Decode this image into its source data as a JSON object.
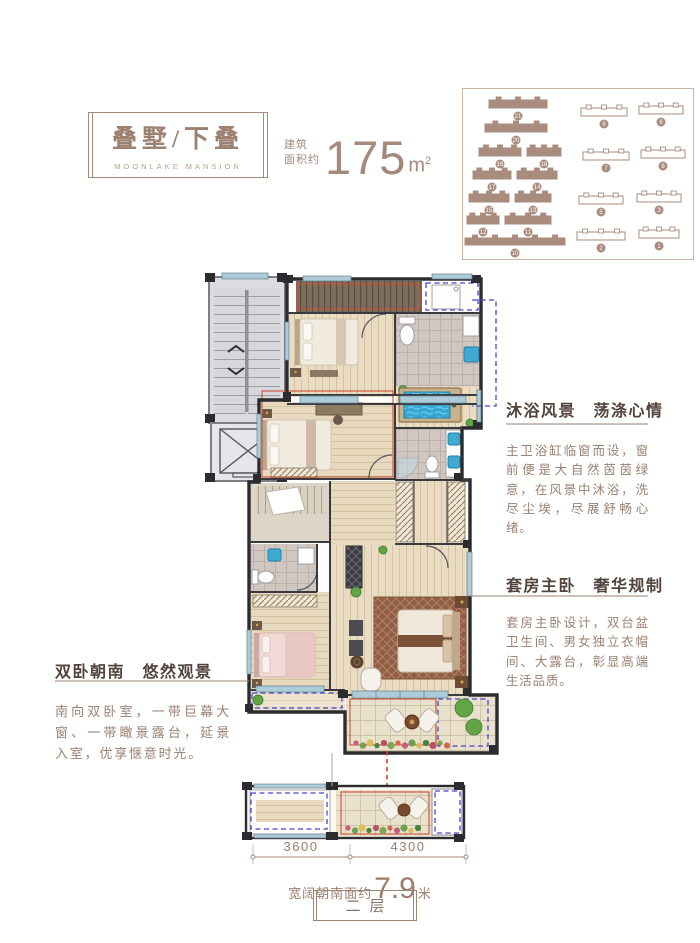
{
  "header": {
    "title": "叠墅/下叠",
    "subtitle": "MOONLAKE MANSION",
    "area_label_line1": "建筑",
    "area_label_line2": "面积约",
    "area_value": "175",
    "area_unit": "m",
    "area_sup": "2"
  },
  "site_plan": {
    "buildings": [
      {
        "no": "21",
        "x": 26,
        "y": 8,
        "w": 58,
        "h": 11,
        "hl": true
      },
      {
        "no": "20",
        "x": 22,
        "y": 32,
        "w": 62,
        "h": 11,
        "hl": true
      },
      {
        "no": "16",
        "x": 16,
        "y": 56,
        "w": 42,
        "h": 11,
        "hl": true
      },
      {
        "no": "18",
        "x": 64,
        "y": 56,
        "w": 34,
        "h": 11,
        "hl": true
      },
      {
        "no": "17",
        "x": 10,
        "y": 79,
        "w": 38,
        "h": 11,
        "hl": true
      },
      {
        "no": "14",
        "x": 54,
        "y": 79,
        "w": 40,
        "h": 11,
        "hl": true
      },
      {
        "no": "15",
        "x": 6,
        "y": 102,
        "w": 40,
        "h": 11,
        "hl": true
      },
      {
        "no": "13",
        "x": 52,
        "y": 102,
        "w": 36,
        "h": 11,
        "hl": true
      },
      {
        "no": "12",
        "x": 4,
        "y": 124,
        "w": 32,
        "h": 11,
        "hl": true
      },
      {
        "no": "11",
        "x": 42,
        "y": 124,
        "w": 46,
        "h": 11,
        "hl": true
      },
      {
        "no": "10",
        "x": 2,
        "y": 146,
        "w": 100,
        "h": 10,
        "hl": true
      },
      {
        "no": "9",
        "x": 118,
        "y": 16,
        "w": 46,
        "h": 11,
        "hl": false
      },
      {
        "no": "8",
        "x": 176,
        "y": 14,
        "w": 44,
        "h": 11,
        "hl": false
      },
      {
        "no": "7",
        "x": 120,
        "y": 60,
        "w": 46,
        "h": 11,
        "hl": false
      },
      {
        "no": "6",
        "x": 178,
        "y": 58,
        "w": 44,
        "h": 11,
        "hl": false
      },
      {
        "no": "5",
        "x": 116,
        "y": 104,
        "w": 44,
        "h": 11,
        "hl": false
      },
      {
        "no": "3",
        "x": 174,
        "y": 102,
        "w": 44,
        "h": 11,
        "hl": false
      },
      {
        "no": "2",
        "x": 114,
        "y": 140,
        "w": 48,
        "h": 11,
        "hl": false
      },
      {
        "no": "1",
        "x": 176,
        "y": 138,
        "w": 40,
        "h": 11,
        "hl": false
      }
    ]
  },
  "annotations": {
    "bath": {
      "title": "沐浴风景　荡涤心情",
      "body": "主卫浴缸临窗而设，窗前便是大自然茵茵绿意，在风景中沐浴，洗尽尘埃，尽展舒畅心绪。"
    },
    "suite": {
      "title": "套房主卧　奢华规制",
      "body": "套房主卧设计，双台盆卫生间、男女独立衣帽间、大露台，彰显高端生活品质。"
    },
    "south": {
      "title": "双卧朝南　悠然观景",
      "body": "南向双卧室，一带巨幕大窗、一带瞰景露台，延景入室，优享惬意时光。"
    }
  },
  "dimensions": {
    "left": "3600",
    "right": "4300",
    "width_prefix": "宽阔朝南面约",
    "width_value": "7.9",
    "width_unit": "米"
  },
  "floor_label": "二层",
  "colors": {
    "brand": "#a5897a",
    "annotation_title": "#52443c",
    "annotation_body": "#9a8172",
    "gift_area_outline": "#c9503a",
    "highlight_dashed": "#4444cc",
    "water": "#3fa9d2"
  }
}
